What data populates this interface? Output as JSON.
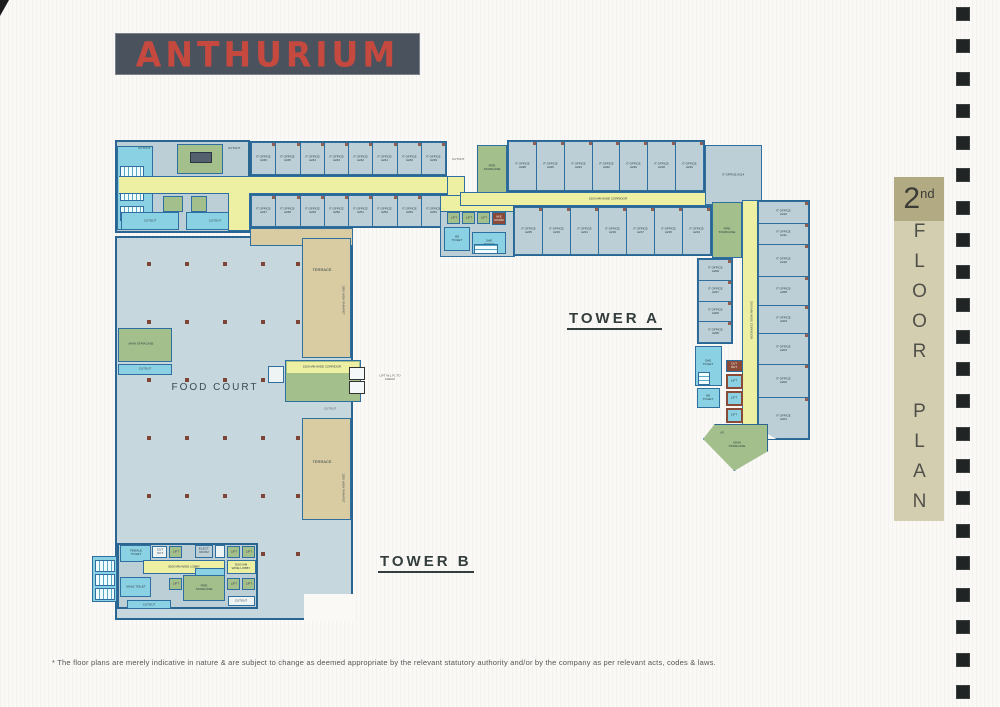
{
  "logo": {
    "text": "ANTHURIUM"
  },
  "floor_tab": {
    "number": "2",
    "suffix": "nd",
    "title": "FLOOR PLAN"
  },
  "film_strip": {
    "square_count": 22
  },
  "plan": {
    "tower_a_label": "TOWER A",
    "tower_b_label": "TOWER B",
    "food_court": "FOOD COURT",
    "terrace": "TERRACE",
    "parapet": "1200 HIGH PARAPET",
    "corridor_h": "1500 MM WIDE CORRIDOR",
    "corridor_v": "1500 MM WIDE CORRIDOR",
    "corridor_mid": "1500 MM WIDE CORRIDOR",
    "lobby_2440": "2440 MM WIDE LOBBY",
    "lobby_3000_a": "3000 MM WIDE LOBBY",
    "lobby_3000_b": "3000 MM WIDE LOBBY",
    "office_prefix": "IT OFFICE",
    "mid_top_row": [
      "A246",
      "A245",
      "A244",
      "A243",
      "A242",
      "A241",
      "A240",
      "A239"
    ],
    "mid_bottom_row": [
      "A247",
      "A248",
      "A249",
      "A250",
      "A251",
      "A252",
      "A253",
      "A254"
    ],
    "a_top_row": [
      "A228",
      "A226",
      "A224",
      "A222",
      "A220",
      "A218",
      "A216"
    ],
    "a_wide_room": "A214",
    "a_bottom_row": [
      "A225",
      "A223",
      "A221",
      "A219",
      "A217",
      "A215",
      "A213"
    ],
    "arm_left_rooms": [
      "A209",
      "A207",
      "A206",
      "A205"
    ],
    "arm_right_rooms": [
      "A212",
      "A211",
      "A210",
      "A208",
      "A204",
      "A203",
      "A202",
      "A201"
    ],
    "rooms": {
      "lift": "LIFT",
      "fire_staircase": "FIRE STAIRCASE",
      "main_staircase": "MAIN STAIRCASE",
      "he_toilet": "HE TOILET",
      "she_toilet": "SHE TOILET",
      "female_toilet": "FEMALE TOILET",
      "male_toilet": "MALE TOILET",
      "elect_room": "ELECT. ROOM",
      "me_room": "M.E ROOM",
      "cutout": "CUTOUT",
      "cut_out": "CUT OUT",
      "up": "UP",
      "lift_note": "LIFT W.L FL TO CHECK"
    }
  },
  "disclaimer": "* The floor plans are merely indicative in nature & are subject to change as deemed appropriate by the relevant statutory authority and/or by the company as per relevant acts, codes & laws.",
  "colors": {
    "wall": "#2b6692",
    "office_fill": "#bccfd6",
    "corridor_yellow": "#edf0a2",
    "staircase_green": "#a3c08c",
    "terrace_tan": "#d9cca2",
    "toilet_cyan": "#8ad1e3",
    "shaft_brown": "#8a4a38",
    "food_court_fill": "#c6d8de",
    "logo_bg": "#4a525e",
    "logo_text": "#c5493f",
    "tab_dark": "#b2aa83",
    "tab_light": "#d4ceb0"
  }
}
